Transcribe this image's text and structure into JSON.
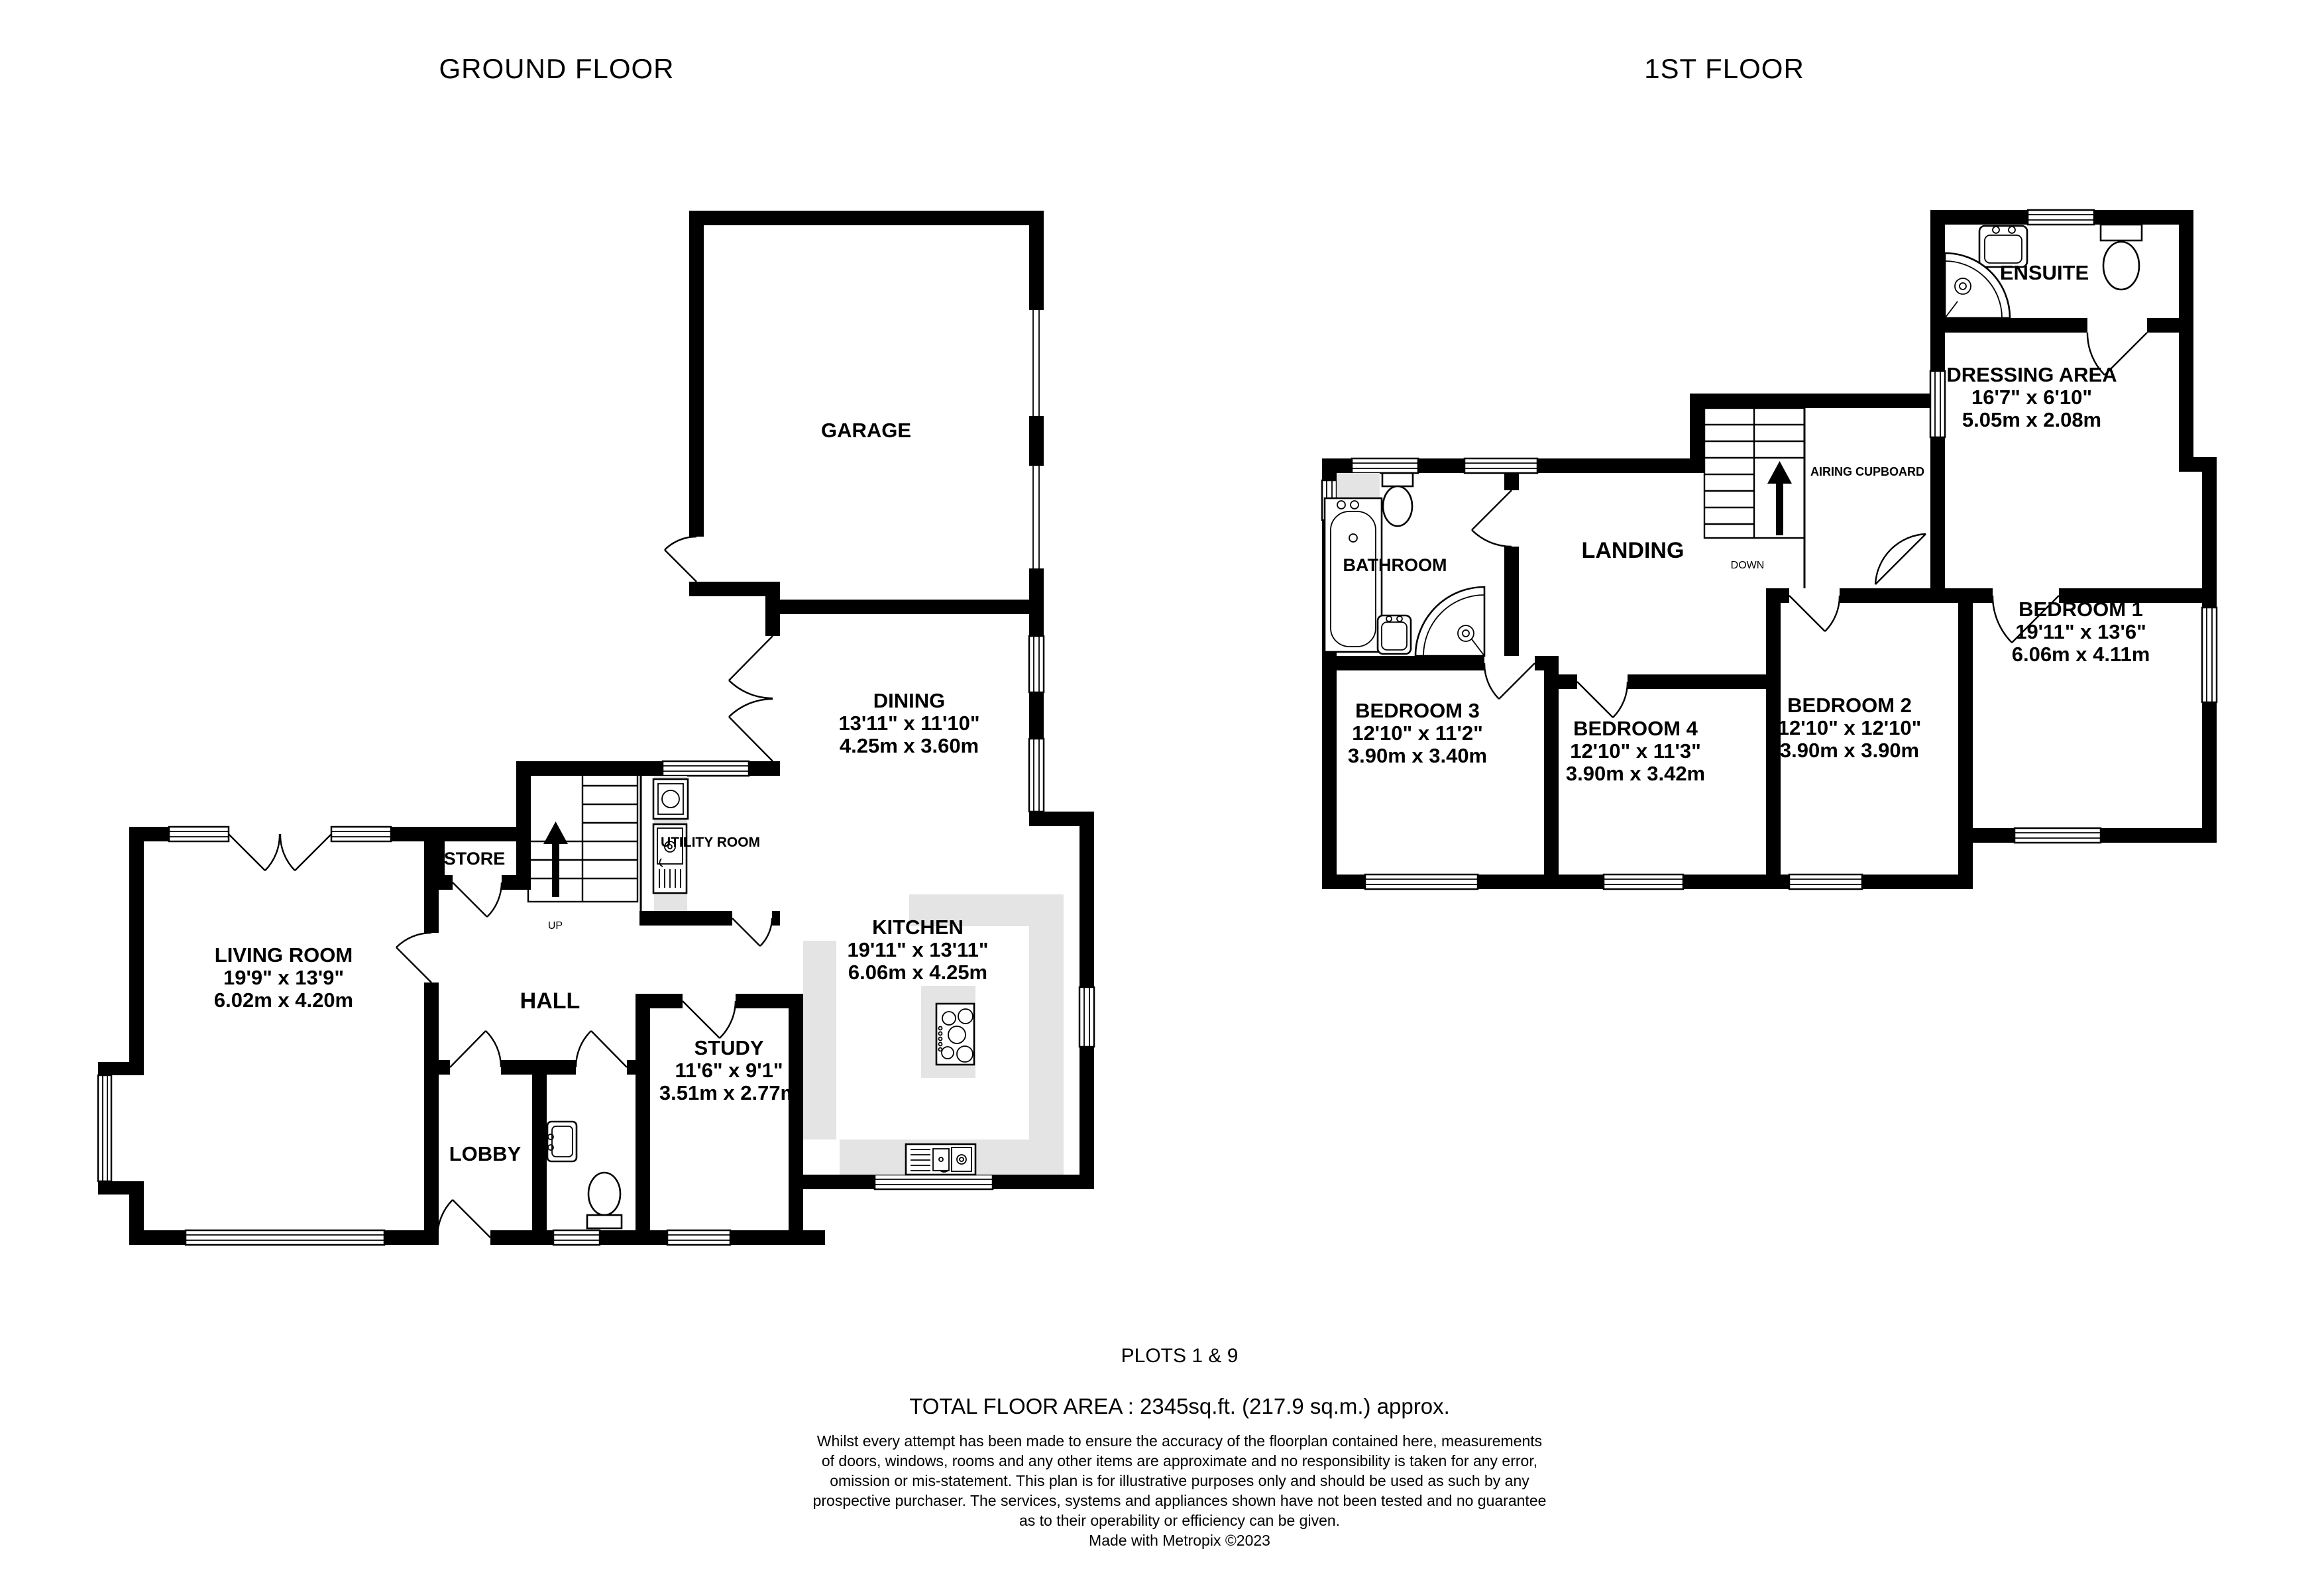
{
  "titles": {
    "ground": "GROUND FLOOR",
    "first": "1ST FLOOR"
  },
  "gf": {
    "rooms": [
      {
        "name": "GARAGE"
      },
      {
        "name": "DINING",
        "imperial": "13'11\" x 11'10\"",
        "metric": "4.25m x 3.60m"
      },
      {
        "name": "KITCHEN",
        "imperial": "19'11\" x 13'11\"",
        "metric": "6.06m x 4.25m"
      },
      {
        "name": "LIVING ROOM",
        "imperial": "19'9\" x 13'9\"",
        "metric": "6.02m x 4.20m"
      },
      {
        "name": "STUDY",
        "imperial": "11'6\" x 9'1\"",
        "metric": "3.51m x 2.77m"
      },
      {
        "name": "HALL"
      },
      {
        "name": "LOBBY"
      },
      {
        "name": "STORE"
      },
      {
        "name": "UTILITY ROOM"
      }
    ],
    "stairs": "UP"
  },
  "ff": {
    "rooms": [
      {
        "name": "BEDROOM 1",
        "imperial": "19'11\" x 13'6\"",
        "metric": "6.06m x 4.11m"
      },
      {
        "name": "BEDROOM 2",
        "imperial": "12'10\" x 12'10\"",
        "metric": "3.90m x 3.90m"
      },
      {
        "name": "BEDROOM 3",
        "imperial": "12'10\" x 11'2\"",
        "metric": "3.90m x 3.40m"
      },
      {
        "name": "BEDROOM 4",
        "imperial": "12'10\" x 11'3\"",
        "metric": "3.90m x 3.42m"
      },
      {
        "name": "DRESSING AREA",
        "imperial": "16'7\" x 6'10\"",
        "metric": "5.05m x 2.08m"
      },
      {
        "name": "ENSUITE"
      },
      {
        "name": "BATHROOM"
      },
      {
        "name": "LANDING"
      },
      {
        "name": "AIRING CUPBOARD"
      }
    ],
    "stairs": "DOWN"
  },
  "footer": {
    "plots": "PLOTS 1 & 9",
    "total_area": "TOTAL FLOOR AREA : 2345sq.ft. (217.9 sq.m.) approx.",
    "disclaimer": [
      "Whilst every attempt has been made to ensure the accuracy of the floorplan contained here, measurements",
      "of doors, windows, rooms and any other items are approximate and no responsibility is taken for any error,",
      "omission or mis-statement. This plan is for illustrative purposes only and should be used as such by any",
      "prospective purchaser. The services, systems and appliances shown have not been tested and no guarantee",
      "as to their operability or efficiency can be given."
    ],
    "credit": "Made with Metropix ©2023"
  }
}
